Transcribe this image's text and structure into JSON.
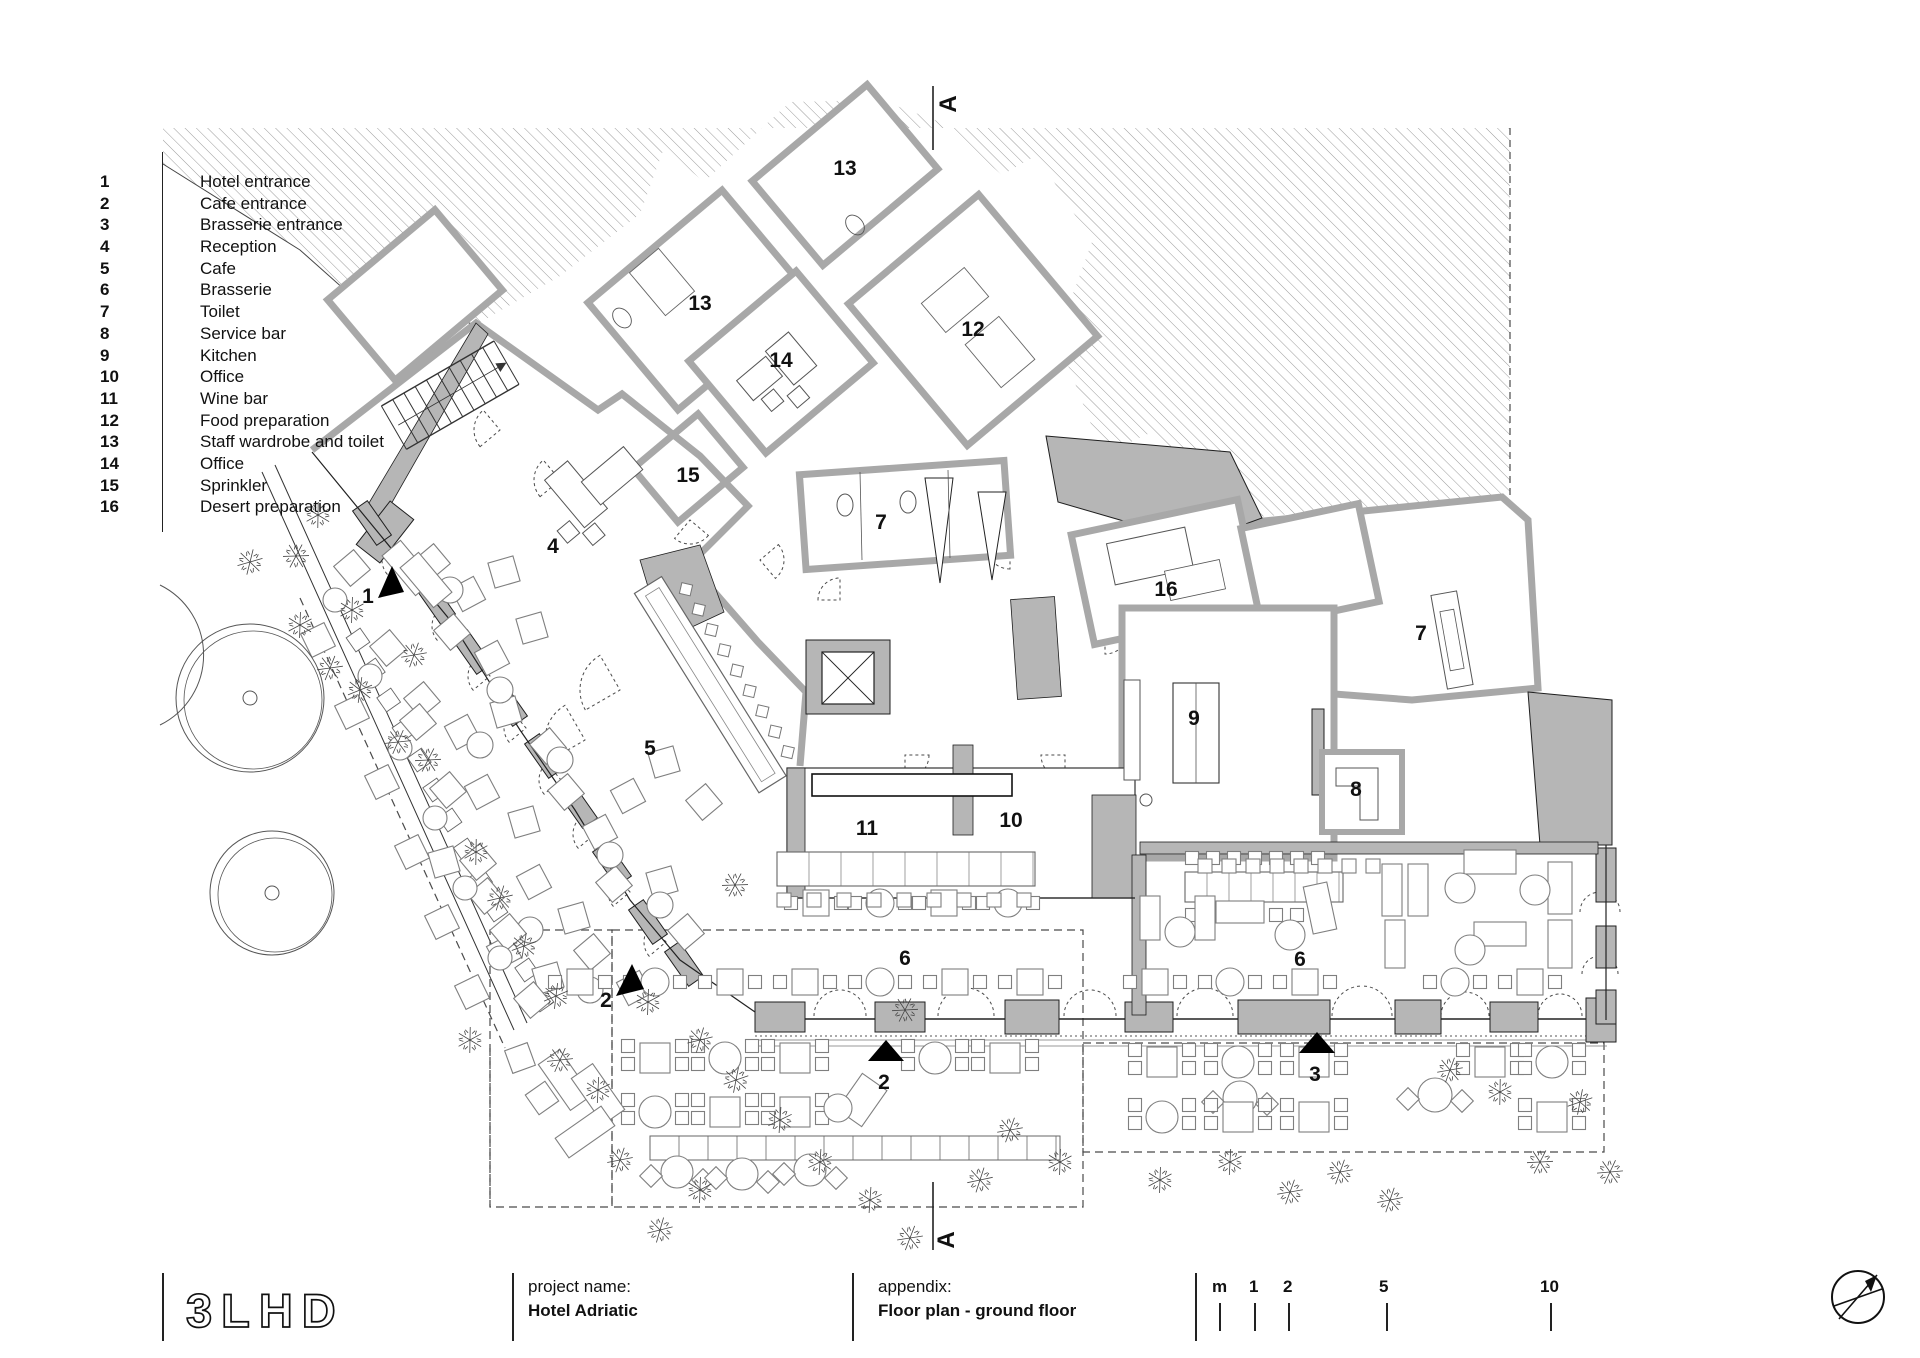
{
  "legend": {
    "items": [
      {
        "num": "1",
        "label": "Hotel entrance"
      },
      {
        "num": "2",
        "label": "Cafe entrance"
      },
      {
        "num": "3",
        "label": "Brasserie entrance"
      },
      {
        "num": "4",
        "label": "Reception"
      },
      {
        "num": "5",
        "label": "Cafe"
      },
      {
        "num": "6",
        "label": "Brasserie"
      },
      {
        "num": "7",
        "label": "Toilet"
      },
      {
        "num": "8",
        "label": "Service bar"
      },
      {
        "num": "9",
        "label": "Kitchen"
      },
      {
        "num": "10",
        "label": "Office"
      },
      {
        "num": "11",
        "label": "Wine bar"
      },
      {
        "num": "12",
        "label": "Food preparation"
      },
      {
        "num": "13",
        "label": "Staff wardrobe and toilet"
      },
      {
        "num": "14",
        "label": "Office"
      },
      {
        "num": "15",
        "label": "Sprinkler"
      },
      {
        "num": "16",
        "label": "Desert preparation"
      }
    ]
  },
  "titlebar": {
    "logo": "3LHD",
    "project_label": "project name:",
    "project_value": "Hotel Adriatic",
    "appendix_label": "appendix:",
    "appendix_value": "Floor plan - ground floor",
    "scale_unit": "m",
    "scale_marks": [
      "1",
      "2",
      "5",
      "10"
    ]
  },
  "plan": {
    "section_marker": "A",
    "room_labels": [
      {
        "id": "staff-wardrobe-toilet-upper",
        "text": "13"
      },
      {
        "id": "staff-wardrobe-toilet-lower",
        "text": "13"
      },
      {
        "id": "food-preparation",
        "text": "12"
      },
      {
        "id": "office-14",
        "text": "14"
      },
      {
        "id": "sprinkler",
        "text": "15"
      },
      {
        "id": "reception",
        "text": "4"
      },
      {
        "id": "toilet-center",
        "text": "7"
      },
      {
        "id": "desert-preparation",
        "text": "16"
      },
      {
        "id": "toilet-east",
        "text": "7"
      },
      {
        "id": "cafe",
        "text": "5"
      },
      {
        "id": "kitchen",
        "text": "9"
      },
      {
        "id": "service-bar",
        "text": "8"
      },
      {
        "id": "wine-bar",
        "text": "11"
      },
      {
        "id": "office-10",
        "text": "10"
      },
      {
        "id": "brasserie-west",
        "text": "6"
      },
      {
        "id": "brasserie-east",
        "text": "6"
      },
      {
        "id": "hotel-entrance",
        "text": "1"
      },
      {
        "id": "cafe-entrance-west",
        "text": "2"
      },
      {
        "id": "cafe-entrance-south",
        "text": "2"
      },
      {
        "id": "brasserie-entrance",
        "text": "3"
      }
    ]
  },
  "colors": {
    "wall_gray": "#b6b6b6",
    "wall_edge": "#1f1f1f",
    "wall_stroke": "#a8a8a8",
    "hatch_line": "#9b9b9b",
    "furniture": "#7f7f7f",
    "dashed": "#4a4a4a"
  }
}
